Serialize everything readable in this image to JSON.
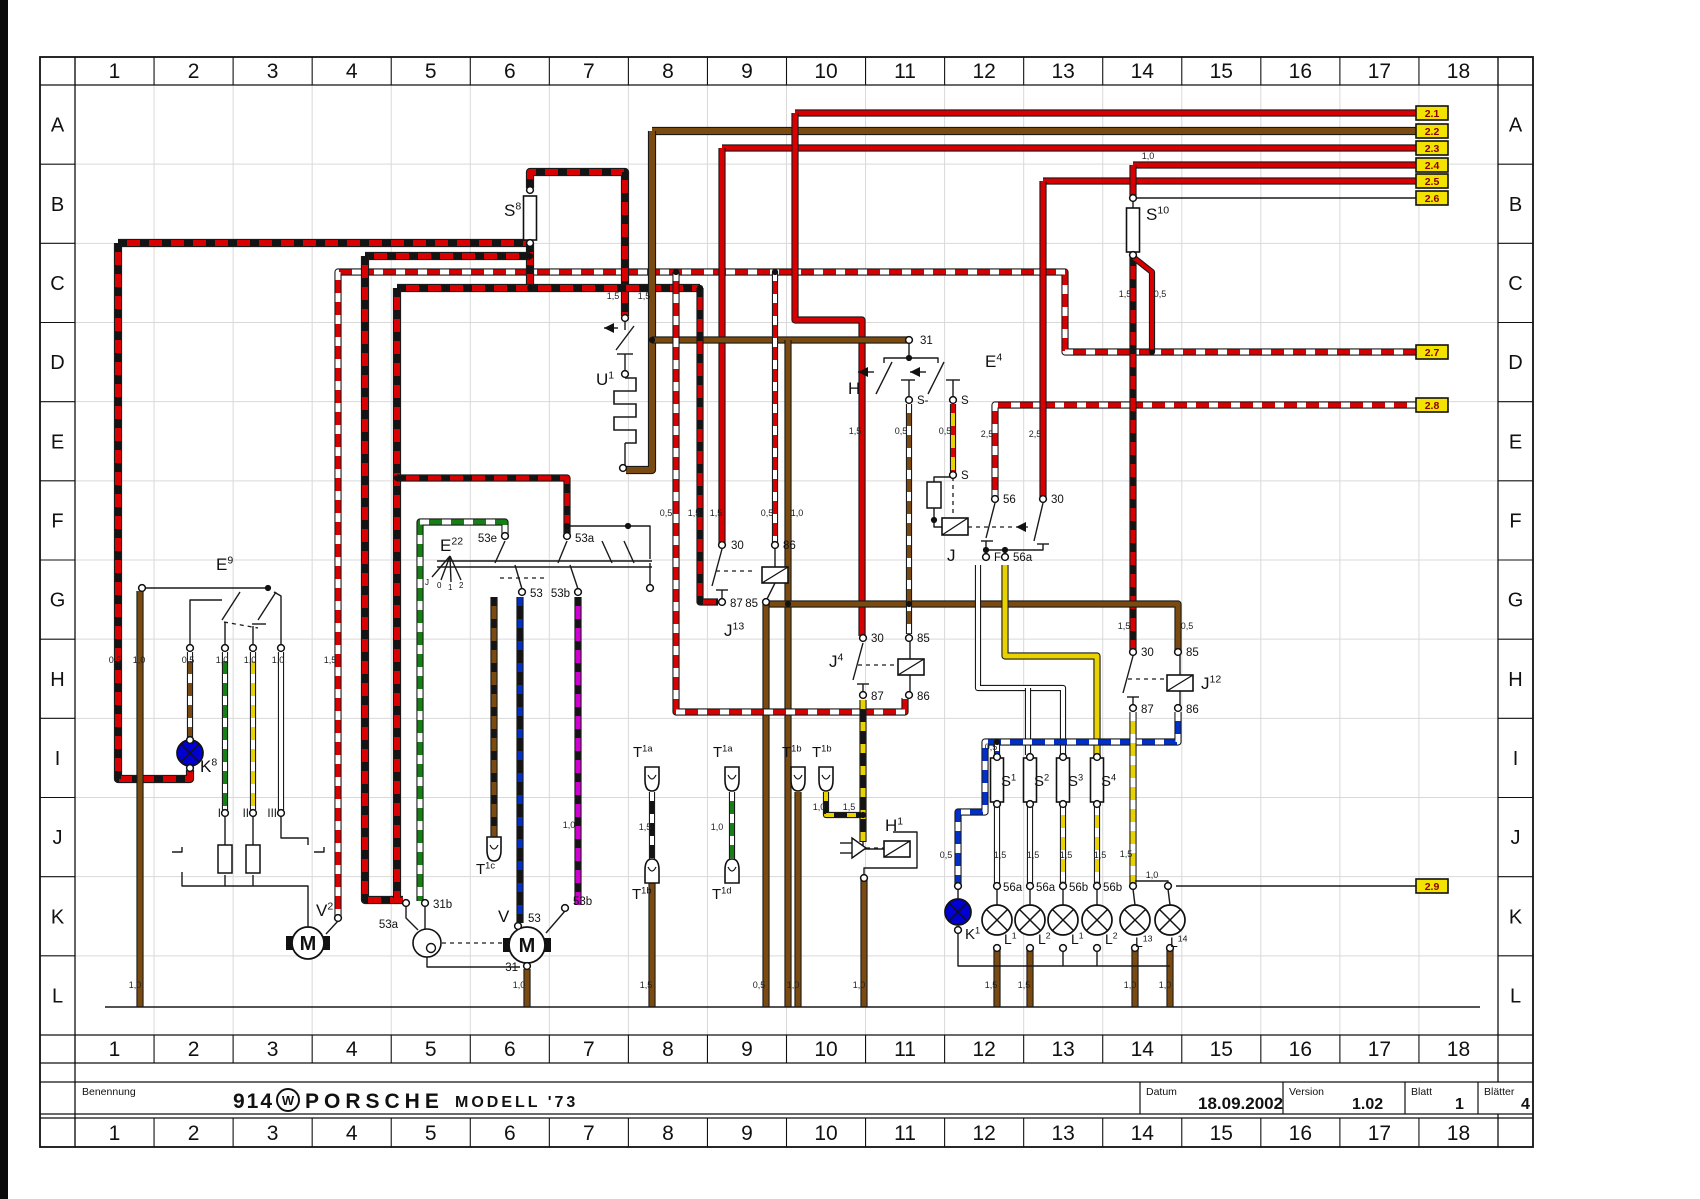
{
  "frame": {
    "columns": [
      "1",
      "2",
      "3",
      "4",
      "5",
      "6",
      "7",
      "8",
      "9",
      "10",
      "11",
      "12",
      "13",
      "14",
      "15",
      "16",
      "17",
      "18"
    ],
    "rows": [
      "A",
      "B",
      "C",
      "D",
      "E",
      "F",
      "G",
      "H",
      "I",
      "J",
      "K",
      "L"
    ]
  },
  "title_block": {
    "benennung_label": "Benennung",
    "brand_left": "914",
    "brand_logo": "vw-logo",
    "brand_right": "PORSCHE",
    "model": "MODELL '73",
    "datum_label": "Datum",
    "datum_value": "18.09.2002",
    "version_label": "Version",
    "version_value": "1.02",
    "blatt_label": "Blatt",
    "blatt_value": "1",
    "blaetter_label": "Blätter",
    "blaetter_value": "4"
  },
  "ref_tags": [
    {
      "label": "2.1",
      "x": 1432,
      "y": 113
    },
    {
      "label": "2.2",
      "x": 1432,
      "y": 131
    },
    {
      "label": "2.3",
      "x": 1432,
      "y": 148
    },
    {
      "label": "2.4",
      "x": 1432,
      "y": 165
    },
    {
      "label": "2.5",
      "x": 1432,
      "y": 181
    },
    {
      "label": "2.6",
      "x": 1432,
      "y": 198
    },
    {
      "label": "2.7",
      "x": 1432,
      "y": 352
    },
    {
      "label": "2.8",
      "x": 1432,
      "y": 405
    },
    {
      "label": "2.9",
      "x": 1432,
      "y": 886
    }
  ],
  "component_labels": [
    {
      "base": "S",
      "sup": "8",
      "x": 504,
      "y": 216
    },
    {
      "base": "S",
      "sup": "10",
      "x": 1146,
      "y": 220
    },
    {
      "base": "U",
      "sup": "1",
      "x": 596,
      "y": 385
    },
    {
      "base": "E",
      "sup": "9",
      "x": 216,
      "y": 570
    },
    {
      "base": "K",
      "sup": "8",
      "x": 200,
      "y": 772
    },
    {
      "base": "E",
      "sup": "22",
      "x": 440,
      "y": 551
    },
    {
      "base": "H",
      "sup": "",
      "x": 848,
      "y": 394
    },
    {
      "base": "E",
      "sup": "4",
      "x": 985,
      "y": 367
    },
    {
      "base": "J",
      "sup": "",
      "x": 947,
      "y": 561
    },
    {
      "base": "J",
      "sup": "13",
      "x": 724,
      "y": 636
    },
    {
      "base": "J",
      "sup": "4",
      "x": 829,
      "y": 667
    },
    {
      "base": "J",
      "sup": "12",
      "x": 1201,
      "y": 689
    },
    {
      "base": "H",
      "sup": "1",
      "x": 885,
      "y": 831
    },
    {
      "base": "S",
      "sup": "1",
      "x": 1001,
      "y": 786,
      "sz": 15
    },
    {
      "base": "S",
      "sup": "2",
      "x": 1034,
      "y": 786,
      "sz": 15
    },
    {
      "base": "S",
      "sup": "3",
      "x": 1068,
      "y": 786,
      "sz": 15
    },
    {
      "base": "S",
      "sup": "4",
      "x": 1101,
      "y": 786,
      "sz": 15
    },
    {
      "base": "K",
      "sup": "1",
      "x": 965,
      "y": 939,
      "sz": 15
    },
    {
      "base": "L",
      "sup": "1",
      "x": 1004,
      "y": 944,
      "sz": 14
    },
    {
      "base": "L",
      "sup": "2",
      "x": 1038,
      "y": 944,
      "sz": 14
    },
    {
      "base": "L",
      "sup": "1",
      "x": 1071,
      "y": 944,
      "sz": 14
    },
    {
      "base": "L",
      "sup": "2",
      "x": 1105,
      "y": 944,
      "sz": 14
    },
    {
      "base": "L",
      "sup": "13",
      "x": 1135,
      "y": 947,
      "sz": 14
    },
    {
      "base": "L",
      "sup": "14",
      "x": 1170,
      "y": 947,
      "sz": 14
    },
    {
      "base": "V",
      "sup": "2",
      "x": 316,
      "y": 916
    },
    {
      "base": "V",
      "sup": "",
      "x": 498,
      "y": 922
    },
    {
      "base": "T",
      "sup": "1a",
      "x": 633,
      "y": 757,
      "sz": 15
    },
    {
      "base": "T",
      "sup": "1a",
      "x": 713,
      "y": 757,
      "sz": 15
    },
    {
      "base": "T",
      "sup": "1b",
      "x": 782,
      "y": 757,
      "sz": 15
    },
    {
      "base": "T",
      "sup": "1b",
      "x": 812,
      "y": 757,
      "sz": 15
    },
    {
      "base": "T",
      "sup": "1c",
      "x": 476,
      "y": 874,
      "sz": 15
    },
    {
      "base": "T",
      "sup": "1b",
      "x": 632,
      "y": 899,
      "sz": 15
    },
    {
      "base": "T",
      "sup": "1d",
      "x": 712,
      "y": 899,
      "sz": 15
    }
  ],
  "terminal_labels": [
    {
      "t": "31",
      "x": 920,
      "y": 344
    },
    {
      "t": "S-",
      "x": 917,
      "y": 404
    },
    {
      "t": "S",
      "x": 961,
      "y": 404
    },
    {
      "t": "S",
      "x": 961,
      "y": 479
    },
    {
      "t": "56",
      "x": 1003,
      "y": 503
    },
    {
      "t": "30",
      "x": 1051,
      "y": 503
    },
    {
      "t": "F",
      "x": 994,
      "y": 561
    },
    {
      "t": "56a",
      "x": 1013,
      "y": 561
    },
    {
      "t": "30",
      "x": 731,
      "y": 549
    },
    {
      "t": "86",
      "x": 783,
      "y": 549
    },
    {
      "t": "87",
      "x": 730,
      "y": 607
    },
    {
      "t": "85",
      "x": 758,
      "y": 607,
      "a": "e"
    },
    {
      "t": "30",
      "x": 871,
      "y": 642
    },
    {
      "t": "85",
      "x": 917,
      "y": 642
    },
    {
      "t": "87",
      "x": 871,
      "y": 700
    },
    {
      "t": "86",
      "x": 917,
      "y": 700
    },
    {
      "t": "30",
      "x": 1141,
      "y": 656
    },
    {
      "t": "85",
      "x": 1186,
      "y": 656
    },
    {
      "t": "87",
      "x": 1141,
      "y": 713
    },
    {
      "t": "86",
      "x": 1186,
      "y": 713
    },
    {
      "t": "53e",
      "x": 497,
      "y": 542,
      "a": "e"
    },
    {
      "t": "53a",
      "x": 575,
      "y": 542
    },
    {
      "t": "53",
      "x": 530,
      "y": 597
    },
    {
      "t": "53b",
      "x": 570,
      "y": 597,
      "a": "e"
    },
    {
      "t": "53a",
      "x": 398,
      "y": 928,
      "a": "e"
    },
    {
      "t": "31b",
      "x": 433,
      "y": 908
    },
    {
      "t": "53",
      "x": 528,
      "y": 922
    },
    {
      "t": "53b",
      "x": 573,
      "y": 905
    },
    {
      "t": "31",
      "x": 518,
      "y": 971,
      "a": "e"
    },
    {
      "t": "I",
      "x": 221,
      "y": 817,
      "a": "e"
    },
    {
      "t": "II",
      "x": 249,
      "y": 817,
      "a": "e"
    },
    {
      "t": "III",
      "x": 277,
      "y": 817,
      "a": "e"
    },
    {
      "t": "56a",
      "x": 1003,
      "y": 891
    },
    {
      "t": "56a",
      "x": 1036,
      "y": 891
    },
    {
      "t": "56b",
      "x": 1069,
      "y": 891
    },
    {
      "t": "56b",
      "x": 1103,
      "y": 891
    },
    {
      "t": "J",
      "x": 425,
      "y": 585,
      "sz": 8
    },
    {
      "t": "0",
      "x": 437,
      "y": 588,
      "sz": 8
    },
    {
      "t": "1",
      "x": 448,
      "y": 590,
      "sz": 8
    },
    {
      "t": "2",
      "x": 459,
      "y": 588,
      "sz": 8
    }
  ],
  "gauge_labels": [
    {
      "t": "0,5",
      "x": 115,
      "y": 663
    },
    {
      "t": "1,0",
      "x": 139,
      "y": 663
    },
    {
      "t": "0,5",
      "x": 188,
      "y": 663
    },
    {
      "t": "1,0",
      "x": 222,
      "y": 663
    },
    {
      "t": "1,0",
      "x": 250,
      "y": 663
    },
    {
      "t": "1,0",
      "x": 278,
      "y": 663
    },
    {
      "t": "1,5",
      "x": 330,
      "y": 663
    },
    {
      "t": "1,5",
      "x": 613,
      "y": 299
    },
    {
      "t": "1,5",
      "x": 644,
      "y": 299
    },
    {
      "t": "0,5",
      "x": 666,
      "y": 516
    },
    {
      "t": "1,5",
      "x": 694,
      "y": 516
    },
    {
      "t": "1,5",
      "x": 716,
      "y": 516
    },
    {
      "t": "0,5",
      "x": 767,
      "y": 516
    },
    {
      "t": "1,0",
      "x": 797,
      "y": 516
    },
    {
      "t": "1,5",
      "x": 855,
      "y": 434
    },
    {
      "t": "0,5",
      "x": 901,
      "y": 434
    },
    {
      "t": "0,5",
      "x": 945,
      "y": 434
    },
    {
      "t": "2,5",
      "x": 987,
      "y": 437
    },
    {
      "t": "2,5",
      "x": 1035,
      "y": 437
    },
    {
      "t": "1,5",
      "x": 1125,
      "y": 297
    },
    {
      "t": "0,5",
      "x": 1160,
      "y": 297
    },
    {
      "t": "1,5",
      "x": 1124,
      "y": 629
    },
    {
      "t": "0,5",
      "x": 1187,
      "y": 629
    },
    {
      "t": "0,5",
      "x": 946,
      "y": 858
    },
    {
      "t": "1,5",
      "x": 1000,
      "y": 858
    },
    {
      "t": "1,5",
      "x": 1033,
      "y": 858
    },
    {
      "t": "1,5",
      "x": 1066,
      "y": 858
    },
    {
      "t": "1,5",
      "x": 1100,
      "y": 858
    },
    {
      "t": "1,5",
      "x": 1126,
      "y": 857
    },
    {
      "t": "0,5",
      "x": 991,
      "y": 750
    },
    {
      "t": "1,5",
      "x": 849,
      "y": 810
    },
    {
      "t": "1,0",
      "x": 819,
      "y": 810
    },
    {
      "t": "1,5",
      "x": 645,
      "y": 830
    },
    {
      "t": "1,0",
      "x": 717,
      "y": 830
    },
    {
      "t": "1,0",
      "x": 1148,
      "y": 159
    },
    {
      "t": "1,0",
      "x": 1152,
      "y": 878
    },
    {
      "t": "1,0",
      "x": 569,
      "y": 828
    },
    {
      "t": "1,0",
      "x": 135,
      "y": 988
    },
    {
      "t": "1,0",
      "x": 519,
      "y": 988
    },
    {
      "t": "1,5",
      "x": 646,
      "y": 988
    },
    {
      "t": "0,5",
      "x": 759,
      "y": 988
    },
    {
      "t": "1,0",
      "x": 793,
      "y": 988
    },
    {
      "t": "1,0",
      "x": 859,
      "y": 988
    },
    {
      "t": "1,5",
      "x": 991,
      "y": 988
    },
    {
      "t": "1,5",
      "x": 1024,
      "y": 988
    },
    {
      "t": "1,0",
      "x": 1130,
      "y": 988
    },
    {
      "t": "1,0",
      "x": 1165,
      "y": 988
    }
  ],
  "colors": {
    "wire_red": "#d80000",
    "wire_brown": "#7a4a10",
    "wire_green": "#168016",
    "wire_yellow": "#e8d300",
    "wire_magenta": "#cf00cf",
    "wire_blue": "#0030c8",
    "wire_black": "#141414",
    "wire_white": "#ffffff",
    "lamp_blue": "#0000d2",
    "tag_bg": "#f2e300",
    "tag_text": "#8a0000",
    "grid_line": "#d9d9d9"
  }
}
